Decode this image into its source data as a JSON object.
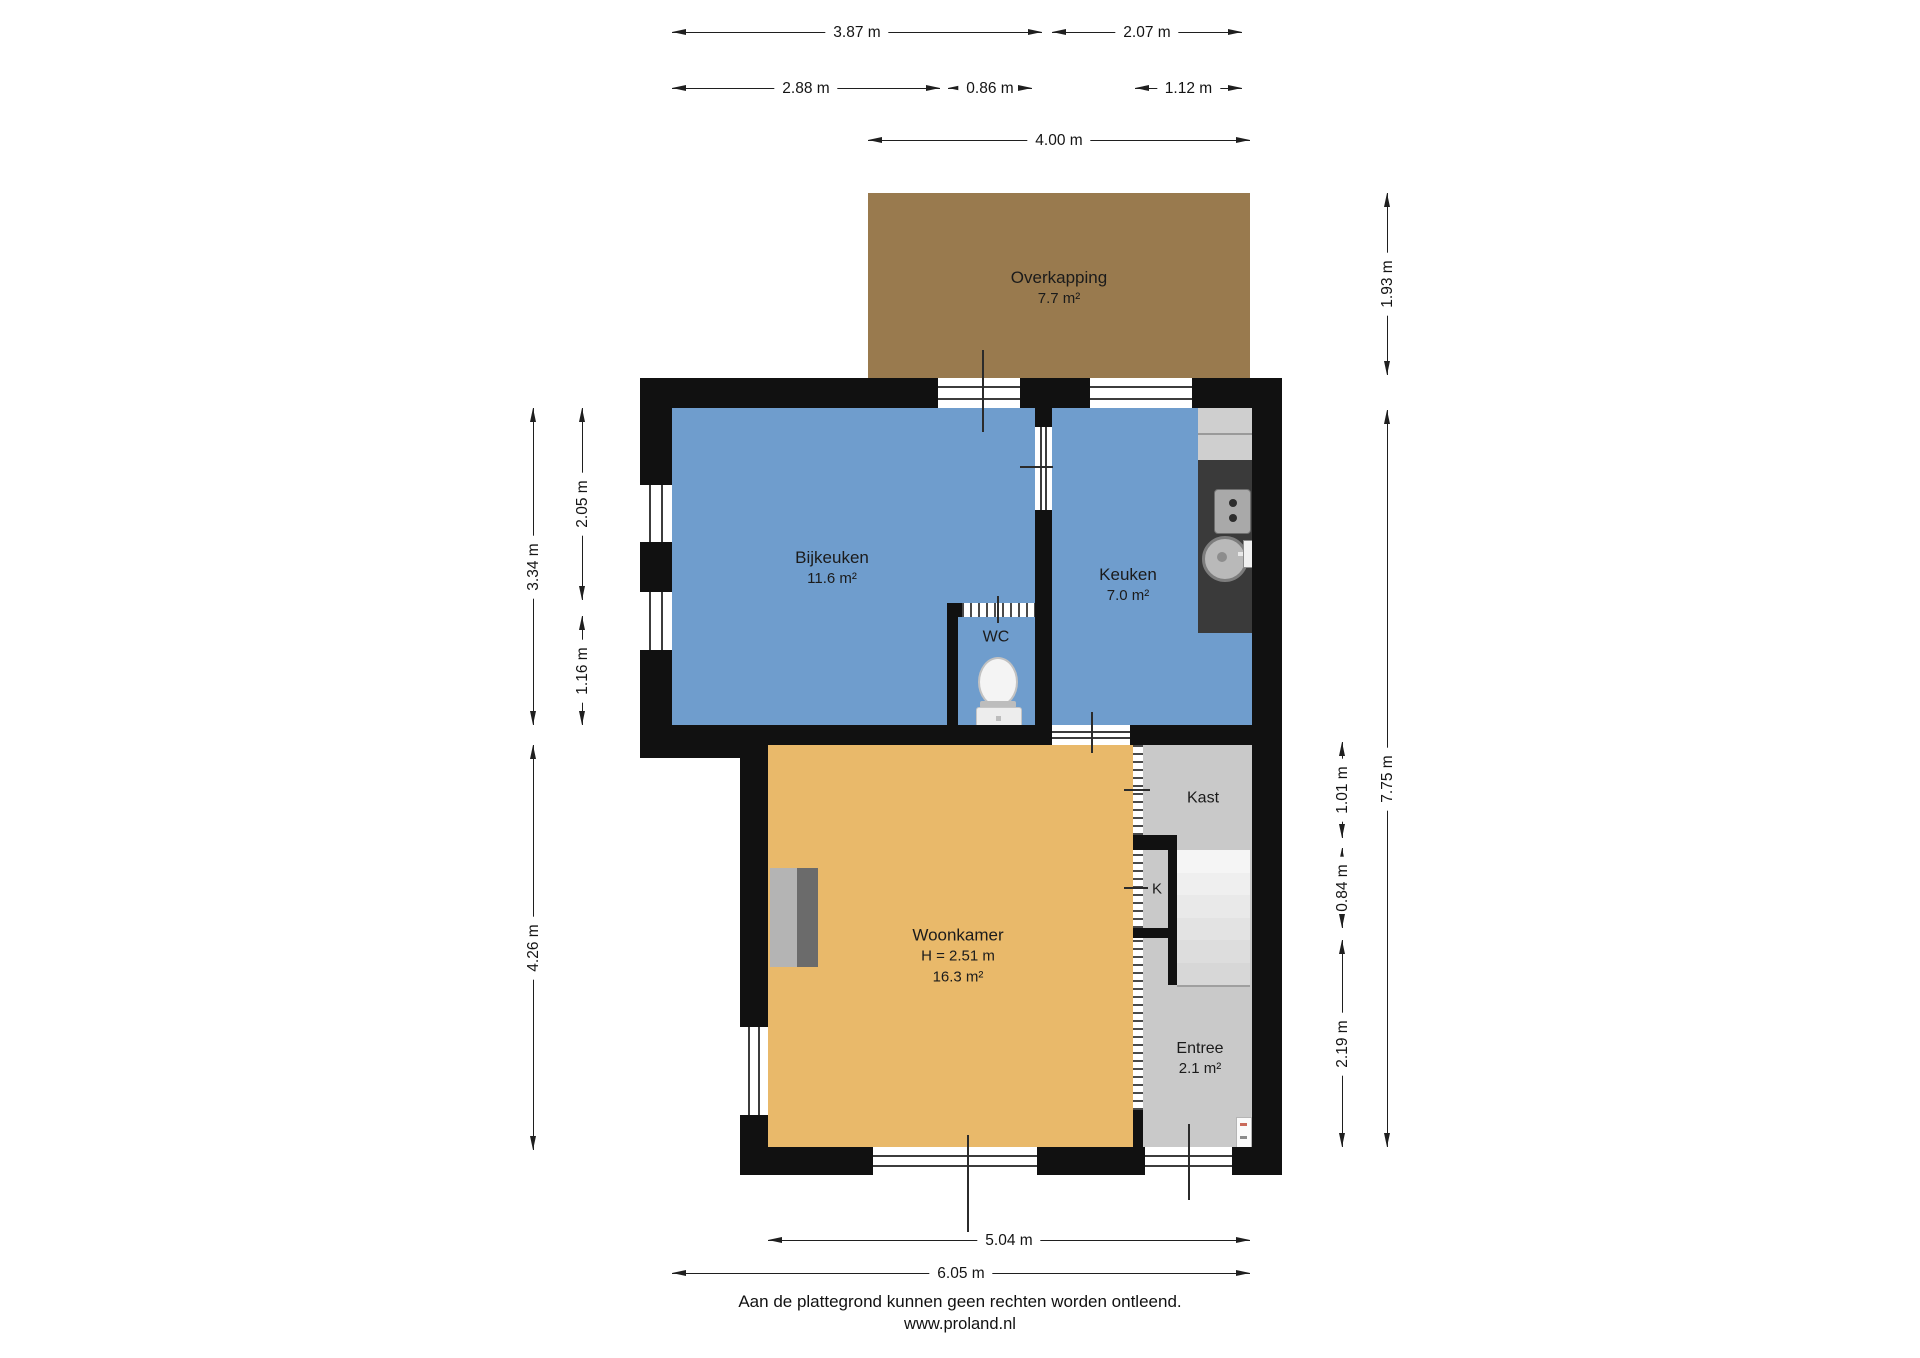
{
  "title": "Plattegrond begane grond",
  "rooms": {
    "overkapping": {
      "name": "Overkapping",
      "area": "7.7 m²"
    },
    "bijkeuken": {
      "name": "Bijkeuken",
      "area": "11.6 m²"
    },
    "keuken": {
      "name": "Keuken",
      "area": "7.0 m²"
    },
    "wc": {
      "name": "WC"
    },
    "woonkamer": {
      "name": "Woonkamer",
      "ceiling_height": "H = 2.51 m",
      "area": "16.3 m²"
    },
    "kast": {
      "name": "Kast"
    },
    "k": {
      "name": "K"
    },
    "entree": {
      "name": "Entree",
      "area": "2.1 m²"
    }
  },
  "dimensions": {
    "d1": "3.87 m",
    "d2": "2.07 m",
    "d3": "2.88 m",
    "d4": "0.86 m",
    "d5": "1.12 m",
    "d6": "4.00 m",
    "d7": "3.34 m",
    "d8": "2.05 m",
    "d9": "1.16 m",
    "d10": "4.26 m",
    "d11": "1.93 m",
    "d12": "7.75 m",
    "d13": "1.01 m",
    "d14": "0.84 m",
    "d15": "2.19 m",
    "d16": "5.04 m",
    "d17": "6.05 m"
  },
  "footer": {
    "disclaimer": "Aan de plattegrond kunnen geen rechten worden ontleend.",
    "website": "www.proland.nl"
  },
  "colors": {
    "wall": "#111111",
    "room_blue": "#6f9dcd",
    "room_orange": "#e9b96a",
    "overkapping_brown": "#997a4e",
    "room_grey": "#c9c9c9",
    "counter_dark": "#3a3a3a"
  }
}
